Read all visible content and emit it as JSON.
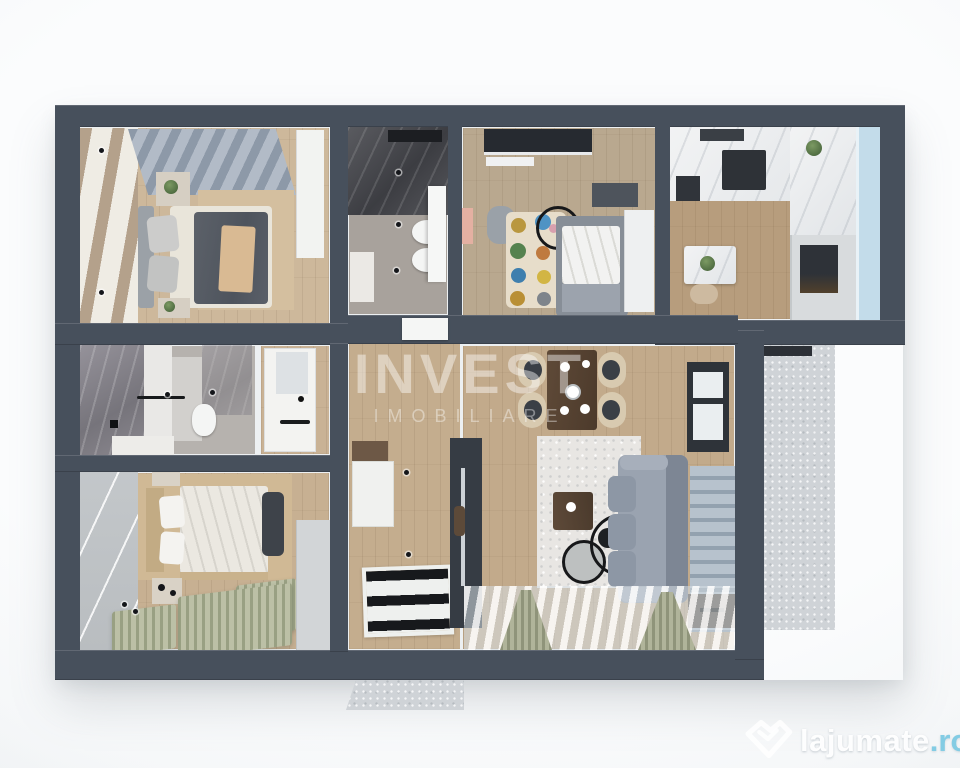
{
  "watermark": {
    "title": "INVEST",
    "subtitle": "IMOBILIARE"
  },
  "logo": {
    "brand": "lajumate",
    "tld": ".ro",
    "icon": "lajumate-heart-icon"
  },
  "colors": {
    "wall": "#47505c",
    "page_background": "#eef1f3",
    "wood_floor": "#c4ad8e",
    "bath_floor": "#a8a29c",
    "concrete": "#cfd3d7",
    "sage_curtain": "#a3a88e",
    "salmon_accent": "#e4b0a2",
    "window_blue": "#c3dcea",
    "sofa_gray": "#9aa3b0",
    "logo_accent": "#82cce4"
  }
}
